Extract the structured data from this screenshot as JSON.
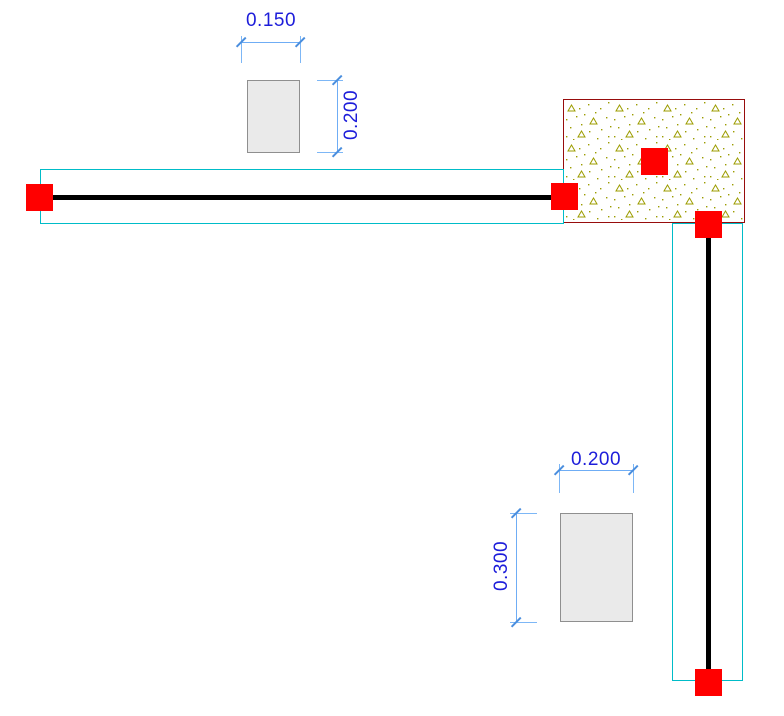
{
  "view": {
    "type": "structural-model-drawing",
    "background": "#ffffff",
    "width_px": 784,
    "height_px": 716
  },
  "palette": {
    "node_fill": "#ff0000",
    "member_centerline": "#000000",
    "member_envelope": "#00bcc8",
    "slab_border": "#970c0c",
    "slab_hatch_symbols": "#9c9c00",
    "section_fill": "#eaeaea",
    "section_border": "#8f8f8f",
    "dimension_text": "#1d1dda",
    "dimension_line": "#6fadf5"
  },
  "sections": [
    {
      "name": "beam-cross-section",
      "width_label": "0.150",
      "height_label": "0.200"
    },
    {
      "name": "column-cross-section",
      "width_label": "0.200",
      "height_label": "0.300"
    }
  ],
  "model": {
    "node_count": 5,
    "members": [
      "horizontal-beam",
      "vertical-column"
    ],
    "regions": [
      "concrete-slab"
    ]
  }
}
